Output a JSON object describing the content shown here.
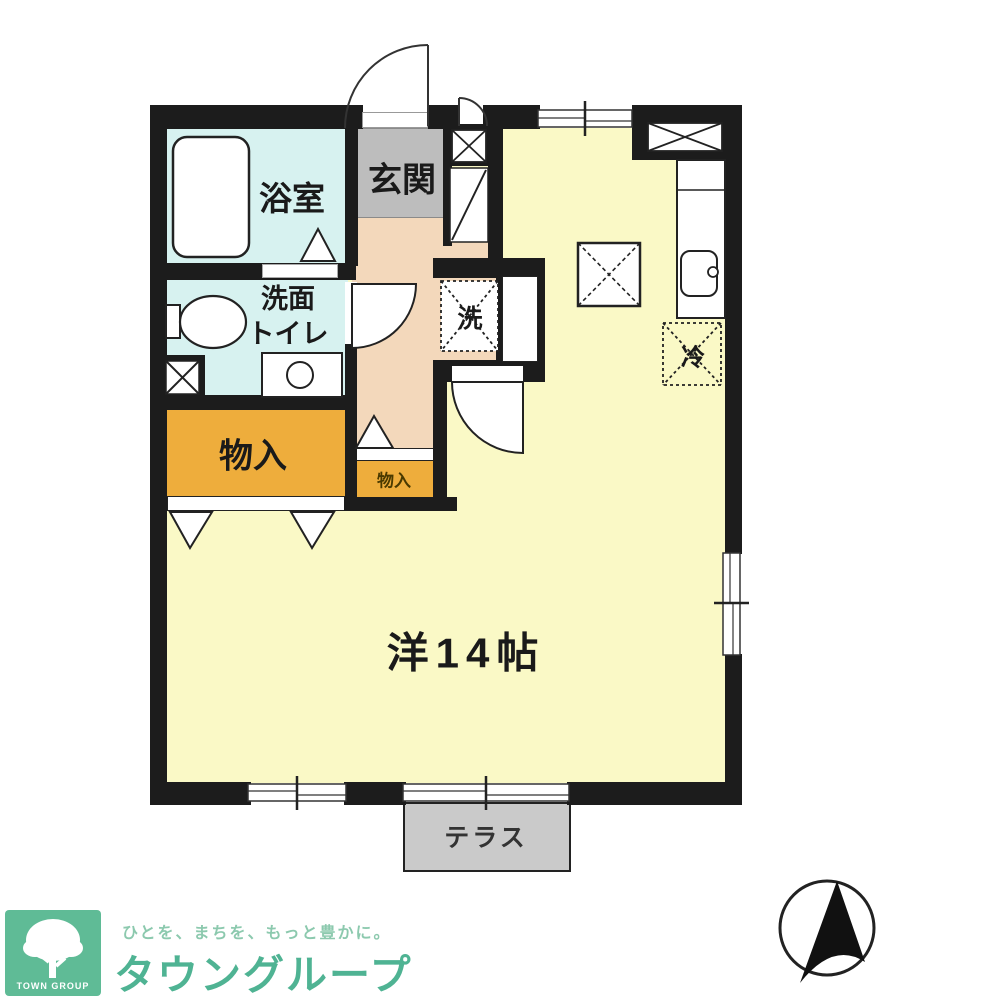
{
  "plan": {
    "rooms": {
      "bathroom": "浴室",
      "entrance": "玄関",
      "washroom_line1": "洗面",
      "washroom_line2": "トイレ",
      "storage_large": "物入",
      "storage_small": "物入",
      "washer": "洗",
      "fridge": "冷",
      "main_room": "洋14帖",
      "terrace": "テラス"
    },
    "colors": {
      "wall": "#1c1c1c",
      "main_room": "#FAF9C6",
      "hallway": "#F3D8BB",
      "wet_area": "#D7F2F0",
      "entrance": "#BDBDBD",
      "storage": "#EEAD3C",
      "terrace": "#CACACA"
    }
  },
  "branding": {
    "mark": "TOWN GROUP",
    "tagline": "ひとを、まちを、もっと豊かに。",
    "name": "タウングループ",
    "green": "#4FB393"
  }
}
